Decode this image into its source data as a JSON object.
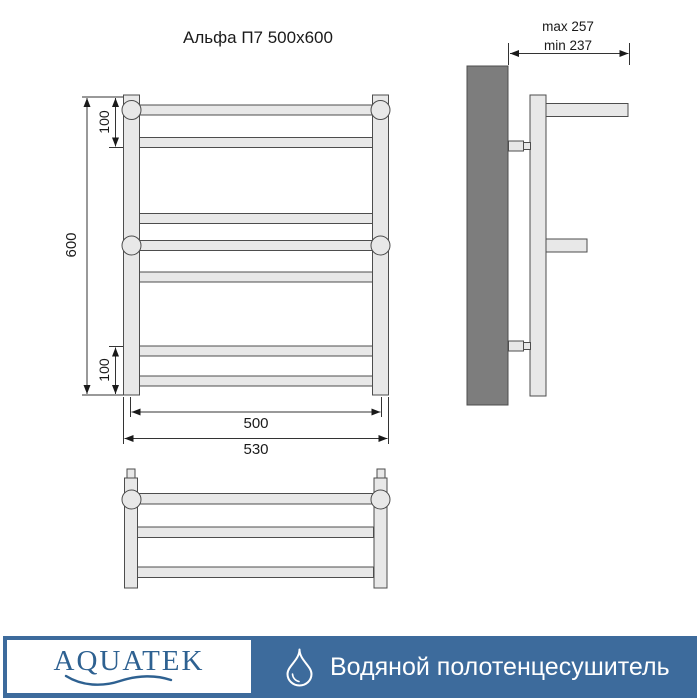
{
  "title": "Альфа П7 500x600",
  "front_view": {
    "height": "600",
    "top_spacing": "100",
    "bottom_spacing": "100",
    "center_width": "500",
    "overall_width": "530"
  },
  "side_view": {
    "max_label": "max 257",
    "min_label": "min 237"
  },
  "footer": {
    "brand": "AQUATEK",
    "product": "Водяной полотенцесушитель"
  },
  "colors": {
    "accent_blue": "#3d6b9c",
    "logo_blue": "#2e6191",
    "metal_fill": "#e8e8e8",
    "outline": "#4d4d4d",
    "wall_fill": "#7d7d7d",
    "text": "#1a1a1a"
  }
}
